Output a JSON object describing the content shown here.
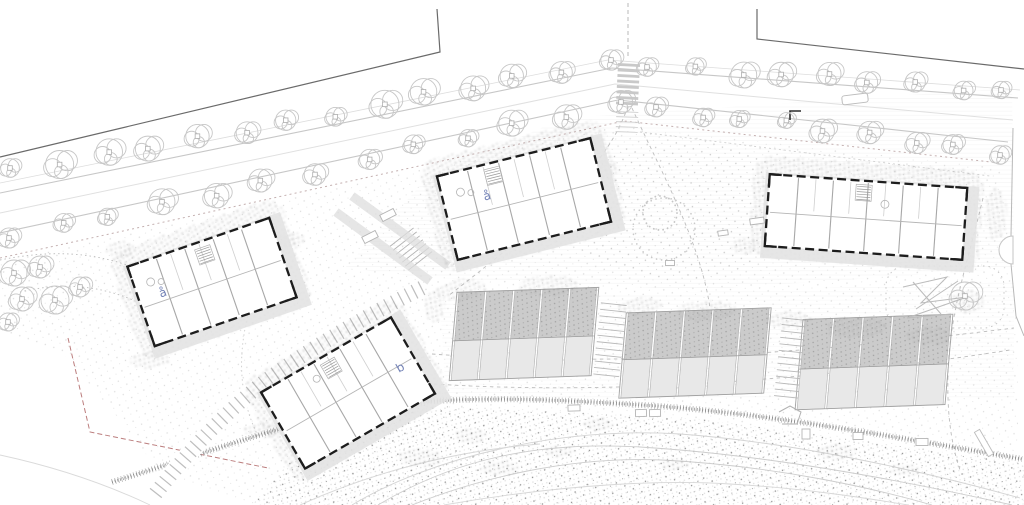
{
  "drawing": {
    "labels": {
      "building_left": "å",
      "building_center": "å",
      "building_lower": "b"
    }
  },
  "colors": {
    "background": "#ffffff",
    "line_faint": "#dedede",
    "line_light": "#c7c7c7",
    "line_mid": "#a8a8a8",
    "boundary_dark": "#666666",
    "wall_black": "#1d1d1d",
    "roof_fill": "#e3e3e3",
    "unit_roof": "#cbcbcb",
    "unit_terrace": "#e8e8e8",
    "accent_blue": "#7382b6",
    "boundary_red": "#bb7d7d",
    "stipple": "#8a8a8a"
  },
  "trees": {
    "street_rows": [
      {
        "x1": 15,
        "y1": 172,
        "x2": 608,
        "y2": 62,
        "count": 14,
        "r": 13
      },
      {
        "x1": 650,
        "y1": 64,
        "x2": 1005,
        "y2": 92,
        "count": 9,
        "r": 12
      },
      {
        "x1": 10,
        "y1": 237,
        "x2": 618,
        "y2": 104,
        "count": 13,
        "r": 12
      },
      {
        "x1": 655,
        "y1": 108,
        "x2": 1000,
        "y2": 152,
        "count": 9,
        "r": 11
      }
    ],
    "garden_cluster": [
      [
        14,
        273,
        13
      ],
      [
        40,
        267,
        11
      ],
      [
        22,
        299,
        12
      ],
      [
        55,
        300,
        14
      ],
      [
        80,
        287,
        10
      ],
      [
        8,
        322,
        9
      ],
      [
        965,
        296,
        14
      ]
    ]
  },
  "vegetation": {
    "clumps": [
      [
        462,
        290,
        26,
        11,
        -6
      ],
      [
        548,
        286,
        30,
        10,
        -3
      ],
      [
        640,
        306,
        22,
        9,
        -4
      ],
      [
        706,
        311,
        30,
        10,
        -3
      ],
      [
        788,
        320,
        24,
        9,
        -2
      ],
      [
        856,
        328,
        30,
        10,
        -2
      ],
      [
        930,
        336,
        24,
        9,
        -2
      ],
      [
        968,
        302,
        16,
        12,
        0
      ],
      [
        996,
        214,
        11,
        26,
        0
      ],
      [
        604,
        170,
        16,
        10,
        0
      ],
      [
        744,
        246,
        13,
        8,
        0
      ],
      [
        434,
        306,
        11,
        16,
        0
      ],
      [
        262,
        430,
        18,
        8,
        0
      ],
      [
        420,
        458,
        22,
        9,
        0
      ],
      [
        500,
        468,
        20,
        8,
        0
      ],
      [
        598,
        424,
        15,
        7,
        0
      ],
      [
        836,
        452,
        20,
        8,
        0
      ],
      [
        120,
        250,
        14,
        9,
        0
      ],
      [
        290,
        240,
        16,
        8,
        0
      ],
      [
        150,
        360,
        20,
        9,
        0
      ],
      [
        470,
        436,
        16,
        7,
        0
      ],
      [
        560,
        452,
        15,
        6,
        0
      ],
      [
        676,
        465,
        14,
        6,
        0
      ],
      [
        905,
        470,
        16,
        6,
        0
      ]
    ]
  },
  "furniture": {
    "benches": [
      [
        757,
        221,
        14,
        6,
        -8
      ],
      [
        723,
        233,
        10,
        5,
        -8
      ],
      [
        670,
        263,
        9,
        5,
        0
      ],
      [
        574,
        408,
        12,
        6,
        -2
      ],
      [
        641,
        413,
        11,
        7,
        -2
      ],
      [
        655,
        413,
        11,
        7,
        -2
      ],
      [
        806,
        434,
        8,
        10,
        0
      ],
      [
        858,
        436,
        10,
        7,
        0
      ],
      [
        922,
        442,
        12,
        7,
        0
      ],
      [
        388,
        215,
        15,
        7,
        -27
      ],
      [
        370,
        237,
        15,
        7,
        -27
      ]
    ],
    "car": [
      855,
      99,
      26,
      9,
      -7
    ],
    "slab": [
      984,
      443,
      28,
      6,
      60
    ]
  }
}
